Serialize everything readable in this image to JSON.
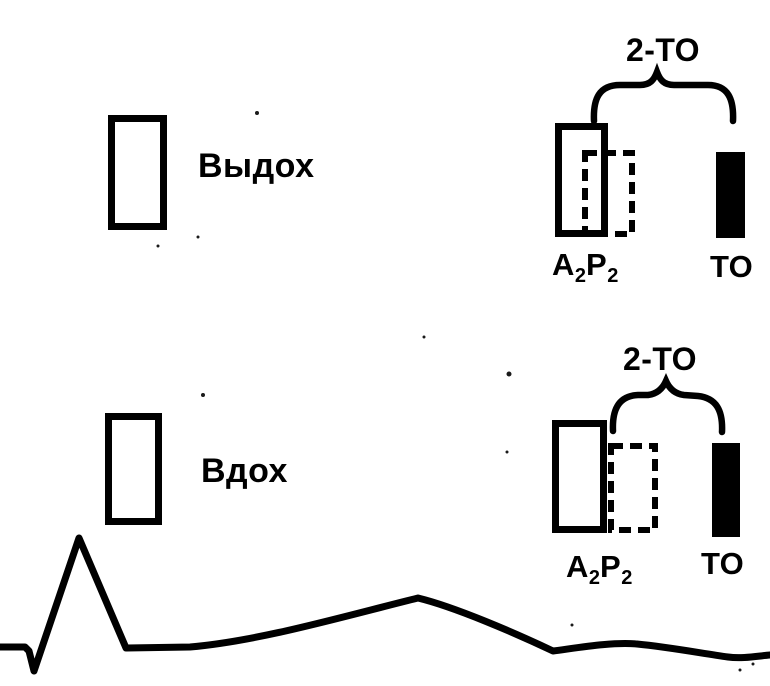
{
  "figure": {
    "type": "medical-diagram",
    "subject": "second heart sound splitting and opening snap during respiration with ECG trace",
    "colors": {
      "ink": "#000000",
      "paper": "#ffffff"
    }
  },
  "expiration": {
    "phase_label": "Выдох",
    "interval_label": "2-ТО",
    "s2_label": {
      "a": "A",
      "a_sub": "2",
      "p": "P",
      "p_sub": "2"
    },
    "os_label": "ТО"
  },
  "inspiration": {
    "phase_label": "Вдох",
    "interval_label": "2-ТО",
    "s2_label": {
      "a": "A",
      "a_sub": "2",
      "p": "P",
      "p_sub": "2"
    },
    "os_label": "ТО"
  }
}
